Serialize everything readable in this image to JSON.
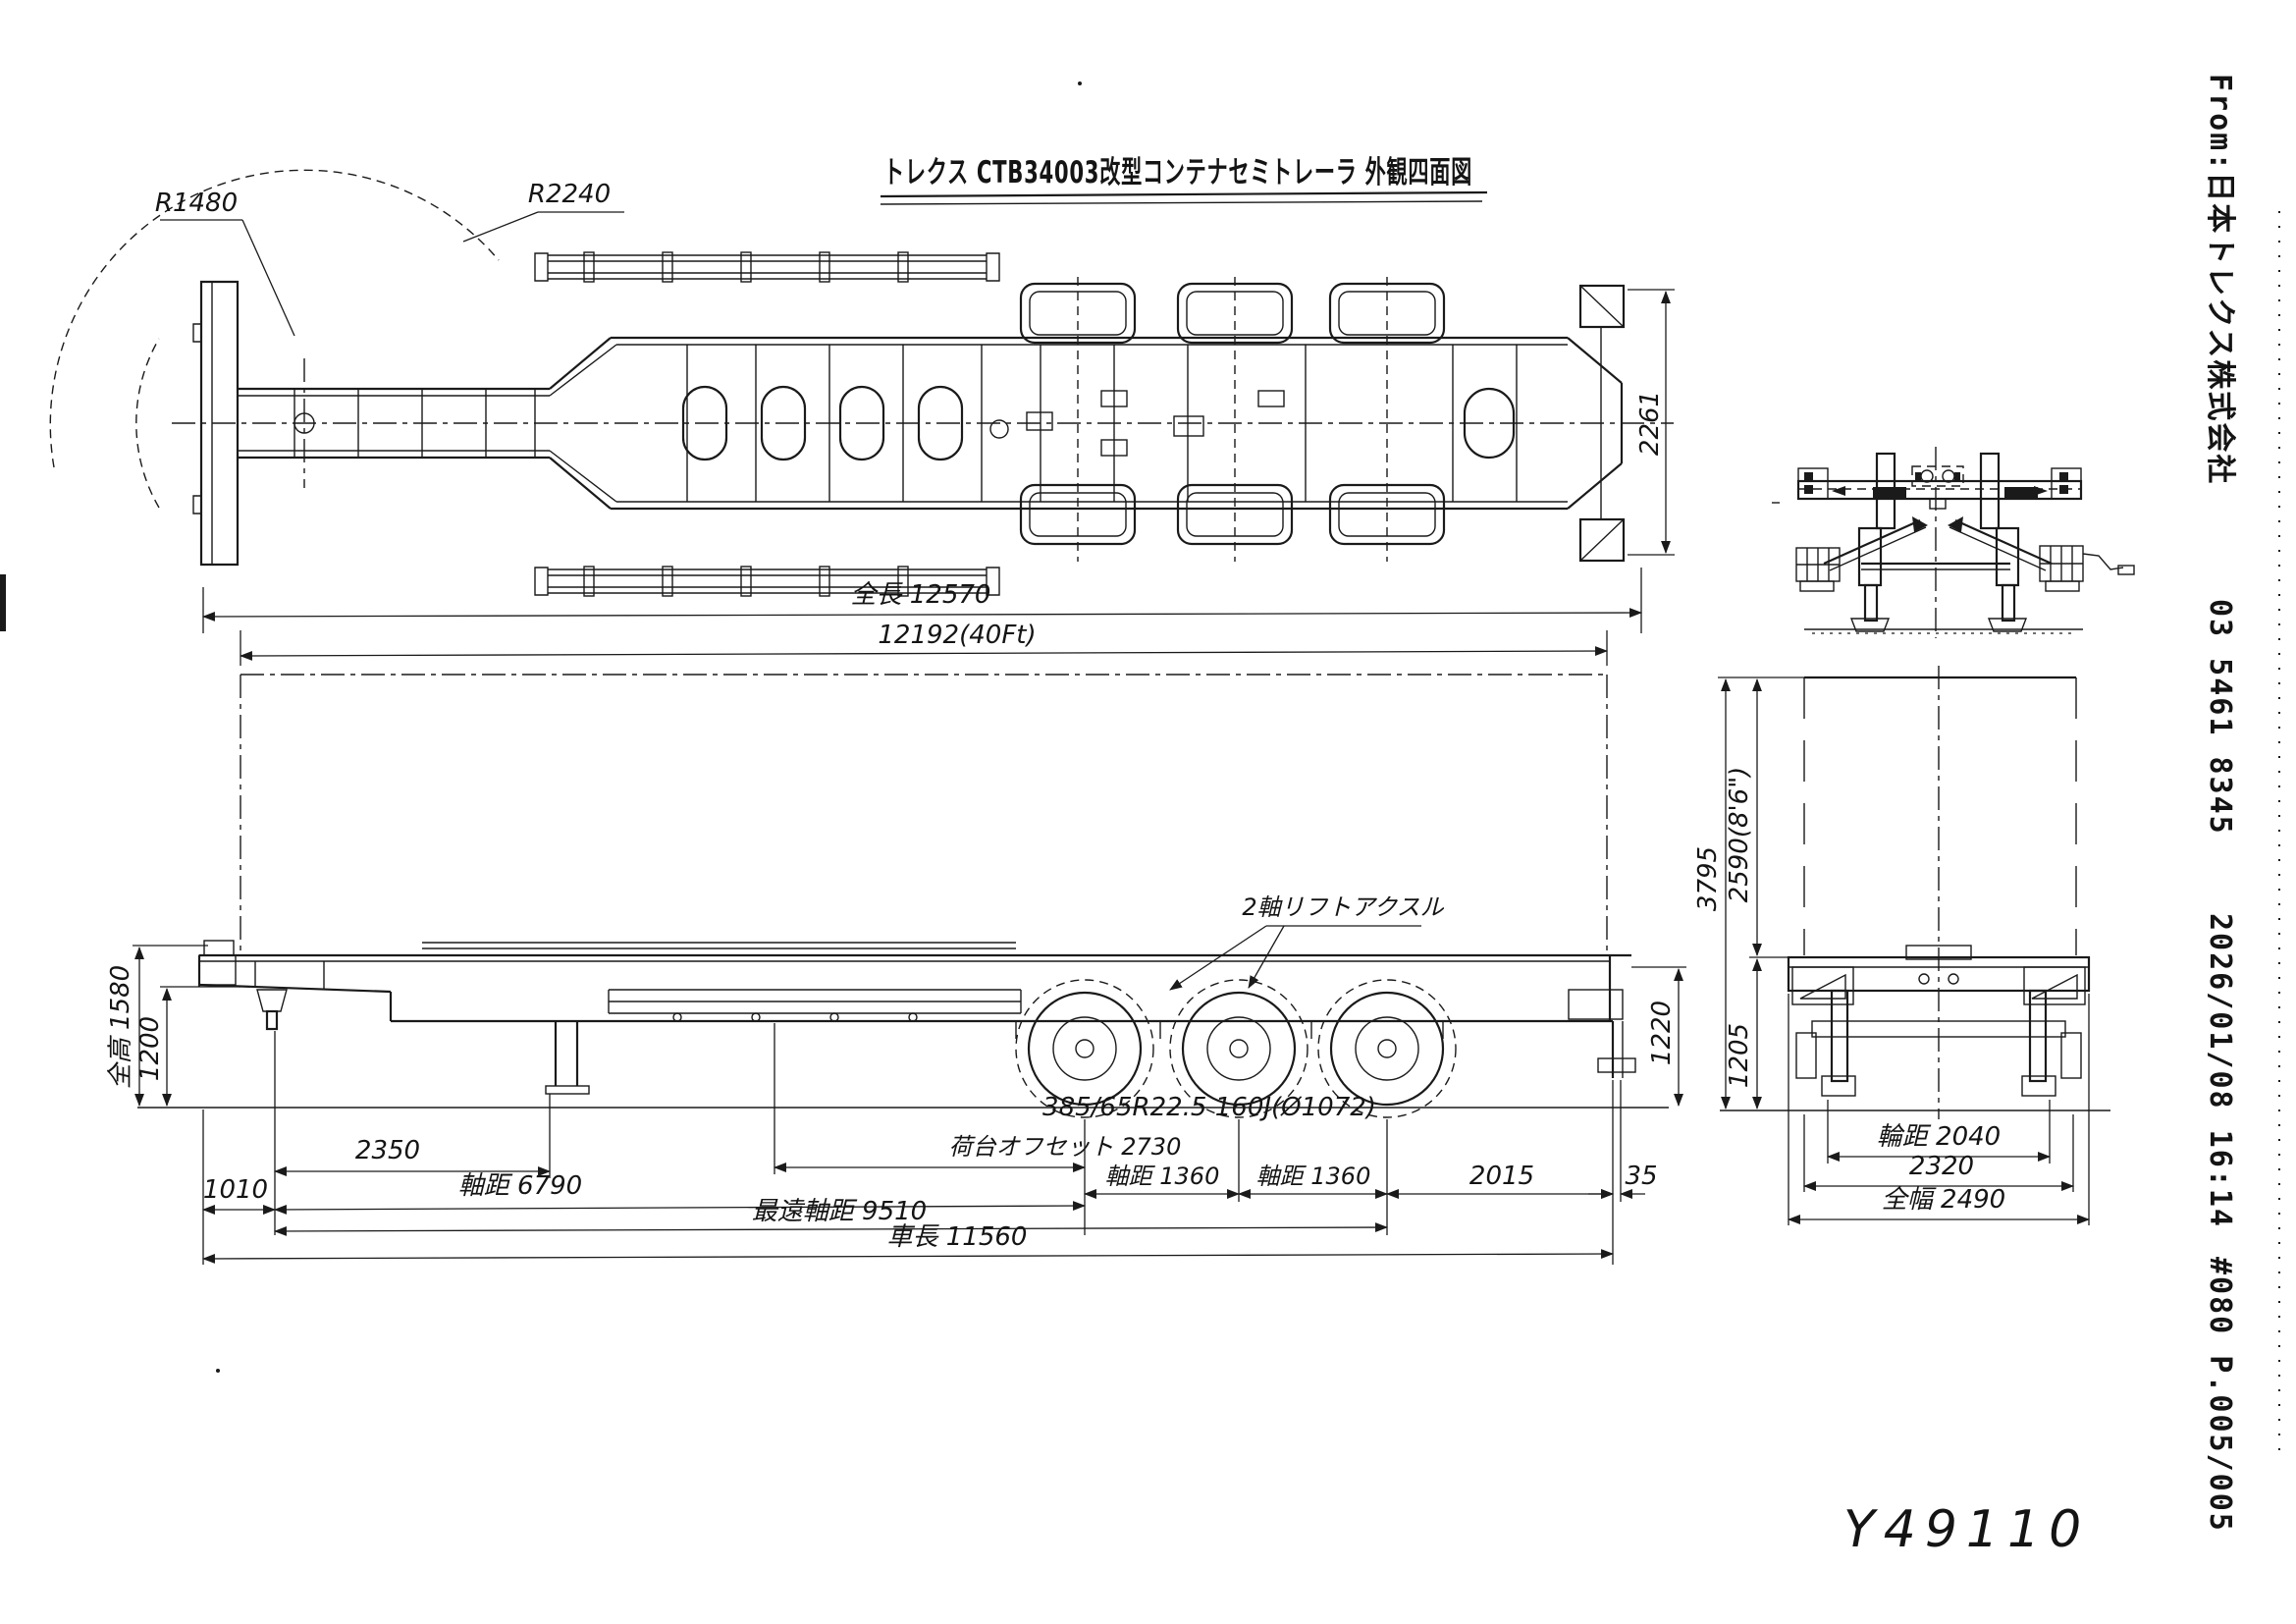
{
  "doc": {
    "title": "トレクス CTB34003改型コンテナセミトレーラ 外観四面図",
    "handwritten_note": "Y49110"
  },
  "colors": {
    "ink": "#1a1a1a",
    "paper": "#ffffff"
  },
  "fax_header": {
    "from": "From:日本トレクス株式会社",
    "phone": "03 5461 8345",
    "datetime": "2026/01/08 16:14",
    "page_info": "#080 P.005/005"
  },
  "top_view": {
    "radius_front": "R1480",
    "radius_rear": "R2240",
    "frame_width": "2261"
  },
  "length_dims": {
    "overall": "全長 12570",
    "container": "12192(40Ft)"
  },
  "side_view": {
    "lift_axle": "2軸リフトアクスル",
    "tire": "385/65R22.5 160J(Ø1072)",
    "overall_height": "全高 1580",
    "front_deck_height": "1200",
    "rear_frame_height": "1220"
  },
  "bottom_dims": {
    "front_overhang": "1010",
    "kingpin_offset": "2350",
    "deck_offset": "荷台オフセット 2730",
    "axle_space_1": "軸距 1360",
    "axle_space_2": "軸距 1360",
    "rear_space": "2015",
    "rear_margin": "35",
    "wheelbase": "軸距 6790",
    "extreme_wheelbase": "最遠軸距 9510",
    "vehicle_length": "車長 11560"
  },
  "rear_view": {
    "total_height": "3795",
    "container_height": "2590(8'6\")",
    "chassis_height": "1205",
    "track": "輪距 2040",
    "frame_width": "2320",
    "overall_width": "全幅 2490"
  }
}
